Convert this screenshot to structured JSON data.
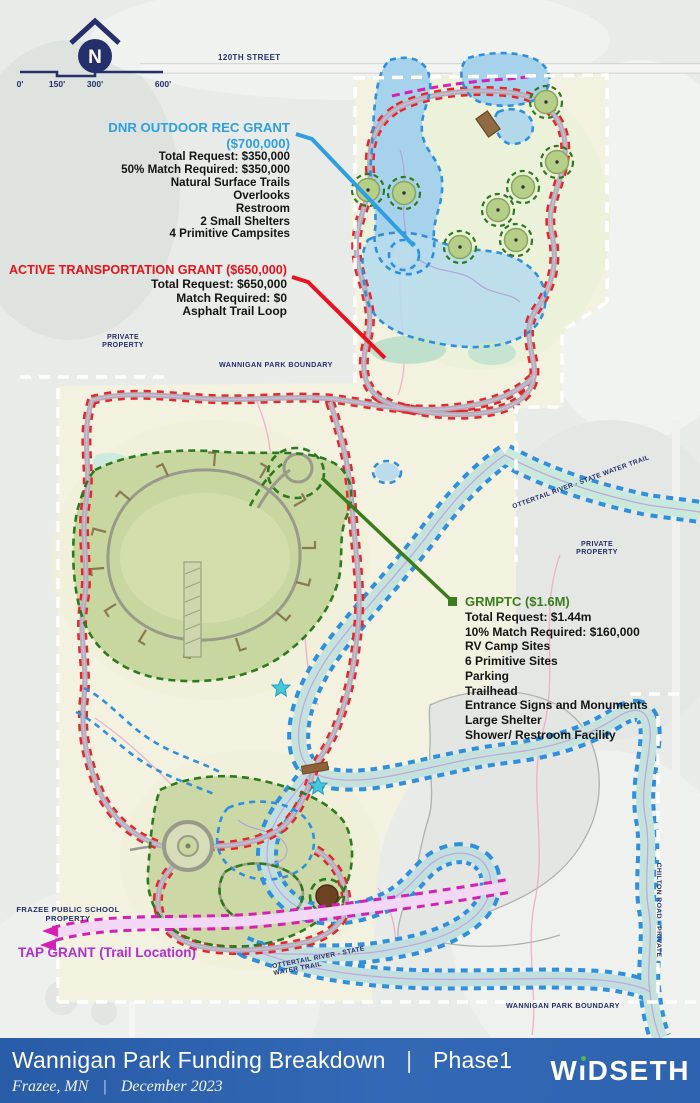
{
  "colors": {
    "navy": "#242f6c",
    "grant_blue": "#2e9fe3",
    "grant_red": "#e8131c",
    "grant_green": "#3b7d1c",
    "tap_magenta": "#b12fd4",
    "trail_red": "#e8252a",
    "trail_blue": "#2f8fdf",
    "trail_green": "#2c7a1d",
    "trail_magenta": "#d81fb4",
    "boundary_white": "#ffffff",
    "footer_blue": "#2d63b0",
    "logo_dot_green": "#55b948",
    "water_blue": "#a6d2ec",
    "river_teal": "#c5e3dc",
    "campground_green": "#c8d6a0",
    "parcel_cream": "#f3f1df"
  },
  "compass": {
    "letter": "N"
  },
  "scalebar": {
    "ticks": [
      "0'",
      "150'",
      "300'",
      "600'"
    ]
  },
  "map_labels": {
    "street": "120TH STREET",
    "private_property_left": "PRIVATE PROPERTY",
    "park_boundary_top": "WANNIGAN PARK BOUNDARY",
    "river_trail_upper": "OTTERTAIL RIVER - STATE WATER TRAIL",
    "private_property_right": "PRIVATE PROPERTY",
    "river_trail_lower": "OTTERTAIL RIVER - STATE WATER TRAIL",
    "park_boundary_bottom": "WANNIGAN PARK BOUNDARY",
    "chilton_road": "CHILTON ROAD - PRIVATE",
    "school_property": "FRAZEE PUBLIC SCHOOL PROPERTY"
  },
  "grants": {
    "dnr": {
      "title": "DNR OUTDOOR REC GRANT",
      "amount": "($700,000)",
      "lines": [
        "Total Request: $350,000",
        "50% Match Required: $350,000",
        "Natural Surface Trails",
        "Overlooks",
        "Restroom",
        "2 Small Shelters",
        "4 Primitive Campsites"
      ]
    },
    "atg": {
      "title": "ACTIVE TRANSPORTATION GRANT ($650,000)",
      "lines": [
        "Total Request: $650,000",
        "Match Required: $0",
        "Asphalt Trail Loop"
      ]
    },
    "grmptc": {
      "title": "GRMPTC ($1.6M)",
      "lines": [
        "Total Request: $1.44m",
        "10% Match Required: $160,000",
        "RV Camp Sites",
        "6 Primitive Sites",
        "Parking",
        "Trailhead",
        "Entrance Signs and Monuments",
        "Large Shelter",
        "Shower/ Restroom Facility"
      ]
    },
    "tap": {
      "title": "TAP GRANT (Trail Location)"
    }
  },
  "footer": {
    "title": "Wannigan Park Funding Breakdown",
    "separator": "|",
    "phase": "Phase1",
    "location": "Frazee, MN",
    "date": "December 2023",
    "logo_text": "WiDSETH",
    "logo_w": "W",
    "logo_i": "ı",
    "logo_rest": "DSETH"
  }
}
